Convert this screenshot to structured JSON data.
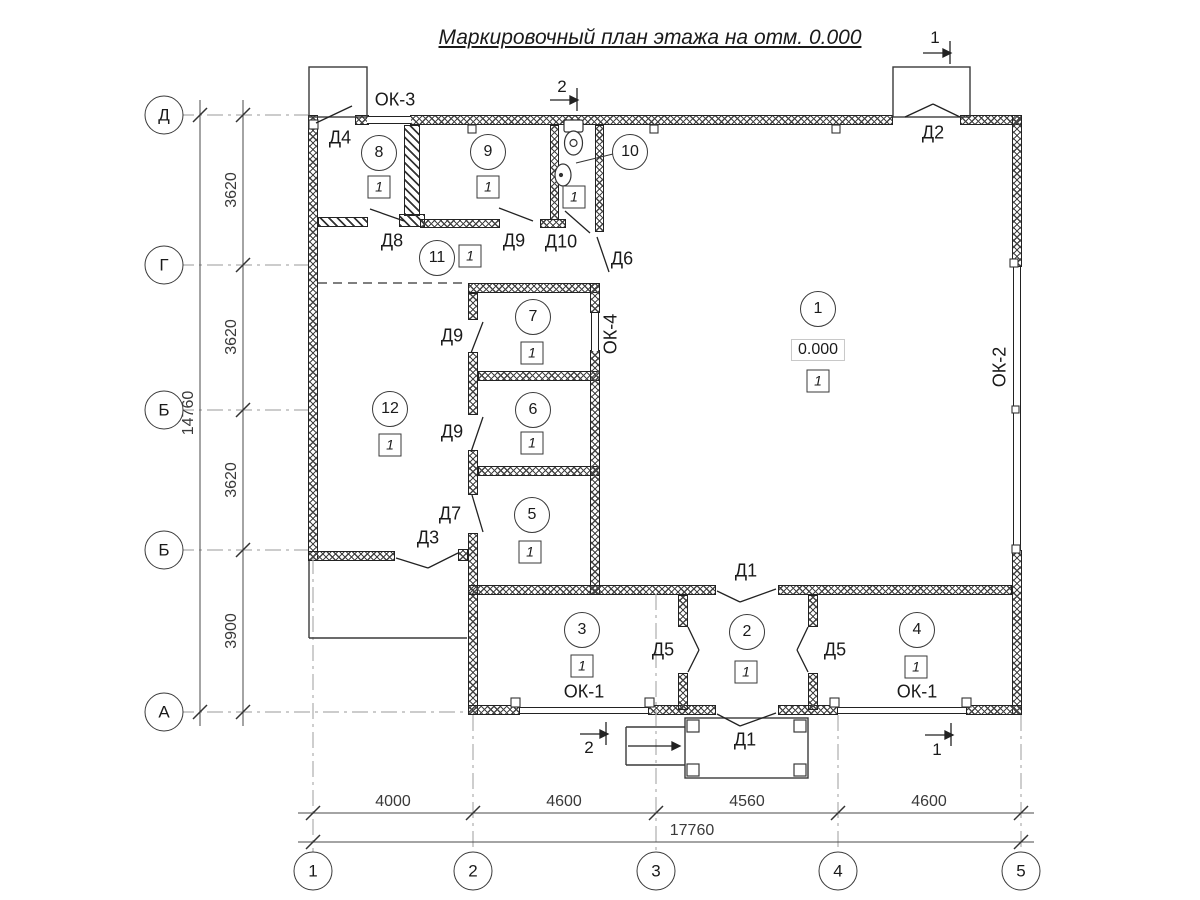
{
  "title": "Маркировочный план этажа на отм. 0.000",
  "axes": {
    "h": [
      "Д",
      "Г",
      "Б",
      "Б",
      "А"
    ],
    "v": [
      "1",
      "2",
      "3",
      "4",
      "5"
    ]
  },
  "dims": {
    "left": [
      "3620",
      "3620",
      "3620",
      "3900"
    ],
    "left_total": "14760",
    "bottom": [
      "4000",
      "4600",
      "4560",
      "4600"
    ],
    "bottom_total": "17760"
  },
  "rooms": {
    "r1": "1",
    "r2": "2",
    "r3": "3",
    "r4": "4",
    "r5": "5",
    "r6": "6",
    "r7": "7",
    "r8": "8",
    "r9": "9",
    "r10": "10",
    "r11": "11",
    "r12": "12"
  },
  "marks": {
    "finish": "1",
    "elevation": "0.000"
  },
  "doors": {
    "d1": "Д1",
    "d2": "Д2",
    "d3": "Д3",
    "d4": "Д4",
    "d5": "Д5",
    "d6": "Д6",
    "d7": "Д7",
    "d8": "Д8",
    "d9": "Д9",
    "d10": "Д10"
  },
  "windows": {
    "ok1": "ОК-1",
    "ok2": "ОК-2",
    "ok3": "ОК-3",
    "ok4": "ОК-4"
  },
  "sections": {
    "s1": "1",
    "s2": "2"
  },
  "icons": [
    "toilet-icon",
    "sink-icon"
  ],
  "colors": {
    "line": "#222222",
    "axis_line": "#adadad",
    "dim_text": "#3a3a3a"
  }
}
